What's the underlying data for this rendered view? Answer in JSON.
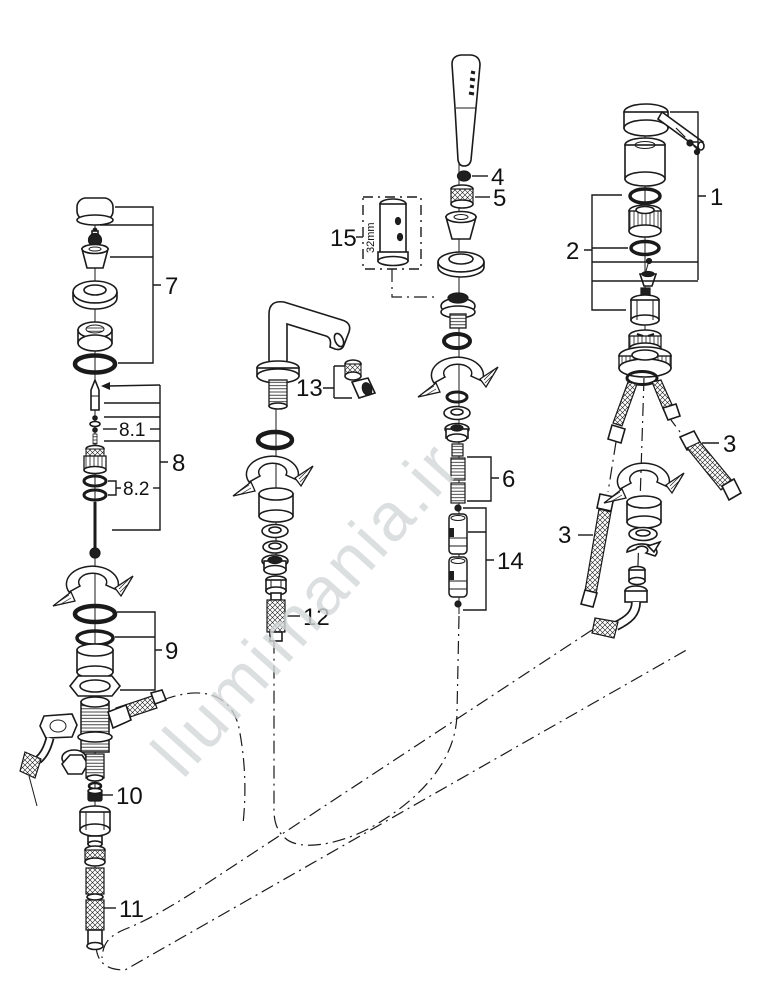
{
  "diagram": {
    "type": "exploded-parts-diagram",
    "product": "bath-mixer-fitting",
    "watermark": "llumimania.ir",
    "tool_box": {
      "label": "15",
      "dimension": "32mm"
    },
    "callouts": {
      "k1": "1",
      "k2": "2",
      "k3_right": "3",
      "k3_left": "3",
      "k4": "4",
      "k5": "5",
      "k6": "6",
      "k7": "7",
      "k8": "8",
      "k8_1": "8.1",
      "k8_2": "8.2",
      "k9": "9",
      "k10": "10",
      "k11": "11",
      "k12": "12",
      "k13": "13",
      "k14": "14",
      "k15": "15"
    },
    "colors": {
      "ink": "#1a1a1a",
      "label": "#111111",
      "watermark": "#d4d8d9",
      "background": "#ffffff"
    }
  }
}
